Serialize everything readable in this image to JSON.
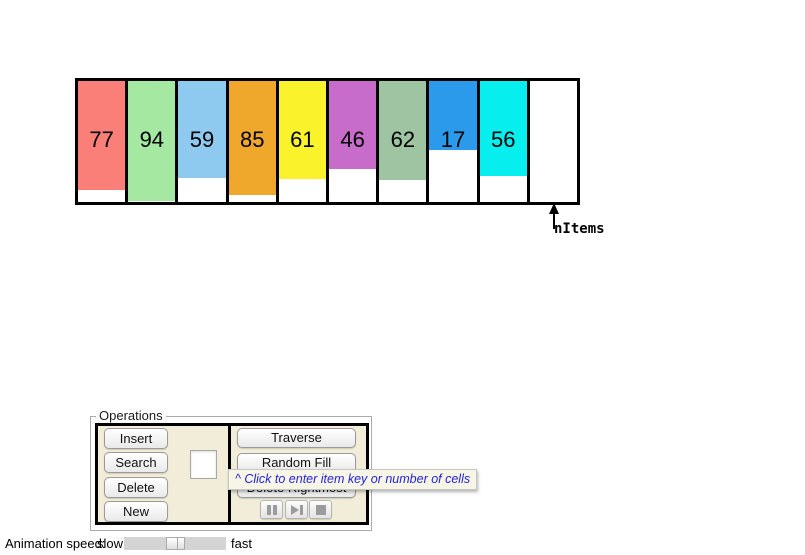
{
  "window": {
    "background": "#FFFFFF"
  },
  "array": {
    "pointer_label": "nItems",
    "cells": [
      {
        "value": 77,
        "color": "#F97F78"
      },
      {
        "value": 94,
        "color": "#A4E8A1"
      },
      {
        "value": 59,
        "color": "#8EC9EF"
      },
      {
        "value": 85,
        "color": "#EFA82B"
      },
      {
        "value": 61,
        "color": "#FAF32B"
      },
      {
        "value": 46,
        "color": "#C76CCA"
      },
      {
        "value": 62,
        "color": "#9FC4A1"
      },
      {
        "value": 17,
        "color": "#2B9AEB"
      },
      {
        "value": 56,
        "color": "#06EEEE"
      },
      {
        "value": null,
        "color": null
      }
    ]
  },
  "operations": {
    "title": "Operations",
    "left_buttons": [
      {
        "label": "Insert"
      },
      {
        "label": "Search"
      },
      {
        "label": "Delete"
      },
      {
        "label": "New"
      }
    ],
    "item_input": {
      "value": ""
    },
    "right_buttons": [
      {
        "label": "Traverse"
      },
      {
        "label": "Random Fill"
      },
      {
        "label": "Delete Rightmost"
      }
    ],
    "playback_buttons": [
      {
        "icon": "pause-icon"
      },
      {
        "icon": "step-forward-icon"
      },
      {
        "icon": "stop-icon"
      }
    ]
  },
  "tooltip": {
    "text": "^ Click to enter item key or number of cells",
    "text_color": "#2323DC"
  },
  "speed_control": {
    "label": "Animation speed:",
    "min_label": "slow",
    "max_label": "fast",
    "position_percent": 50
  }
}
